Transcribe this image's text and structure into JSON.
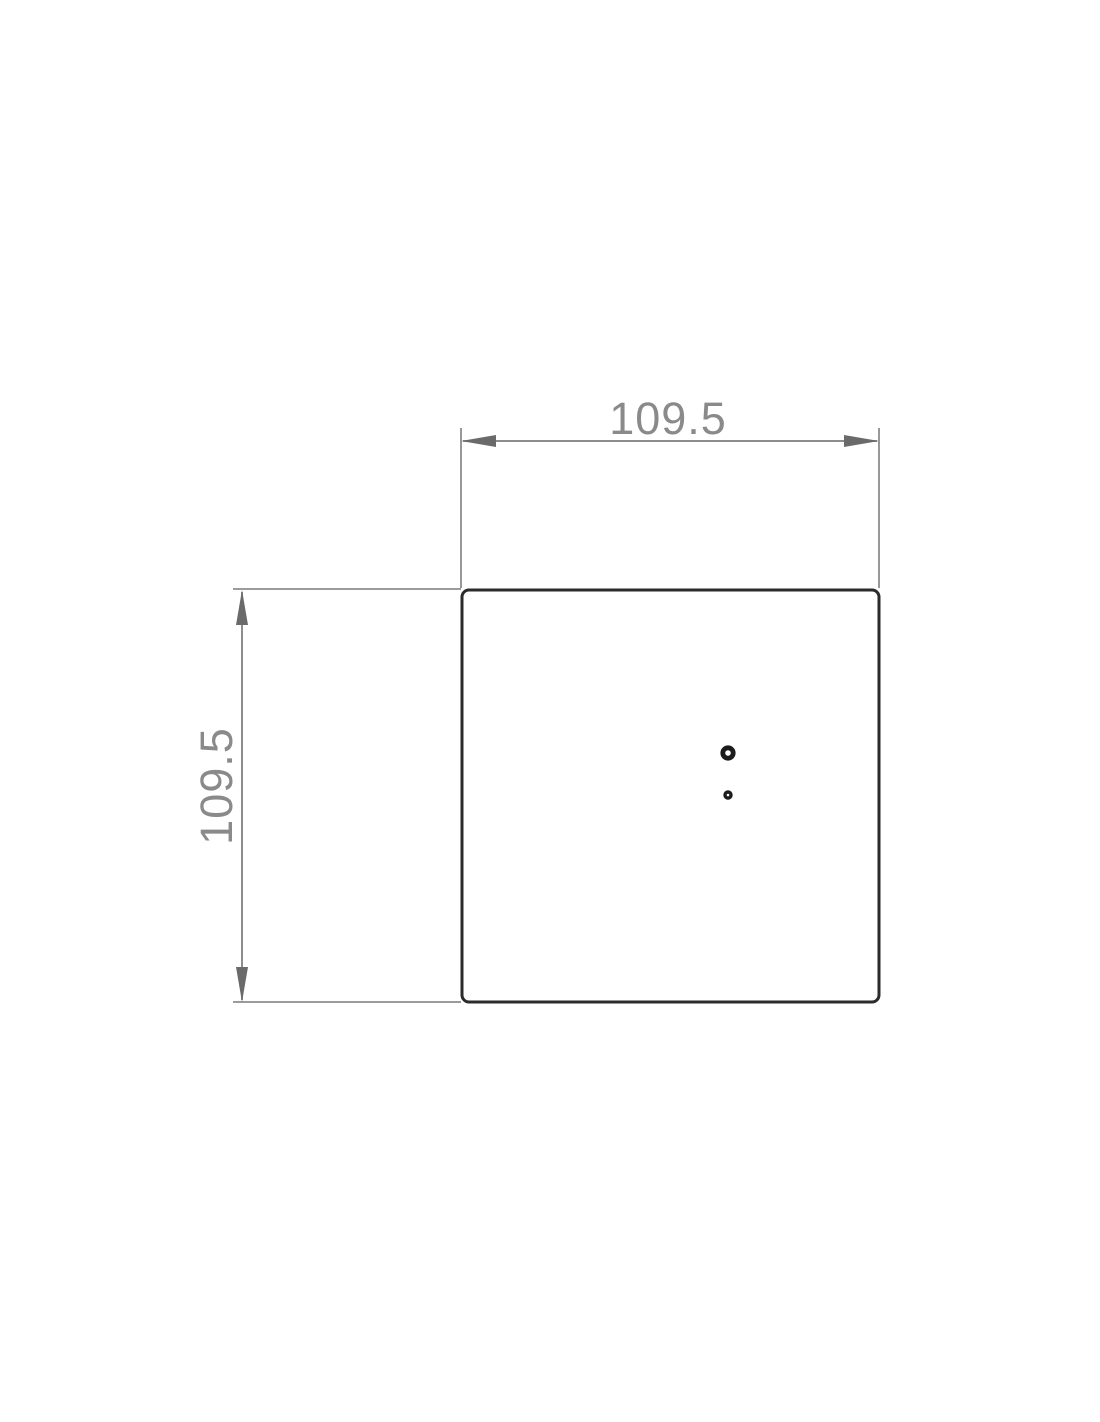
{
  "drawing": {
    "dimensions": {
      "width_label": "109.5",
      "height_label": "109.5"
    },
    "colors": {
      "dim": "#8d8d8d",
      "arrow": "#6a6a6a",
      "dim-text": "#8a8a8a",
      "outline": "#2b2b2b",
      "hole": "#1c1c1c",
      "bg": "#ffffff"
    }
  }
}
